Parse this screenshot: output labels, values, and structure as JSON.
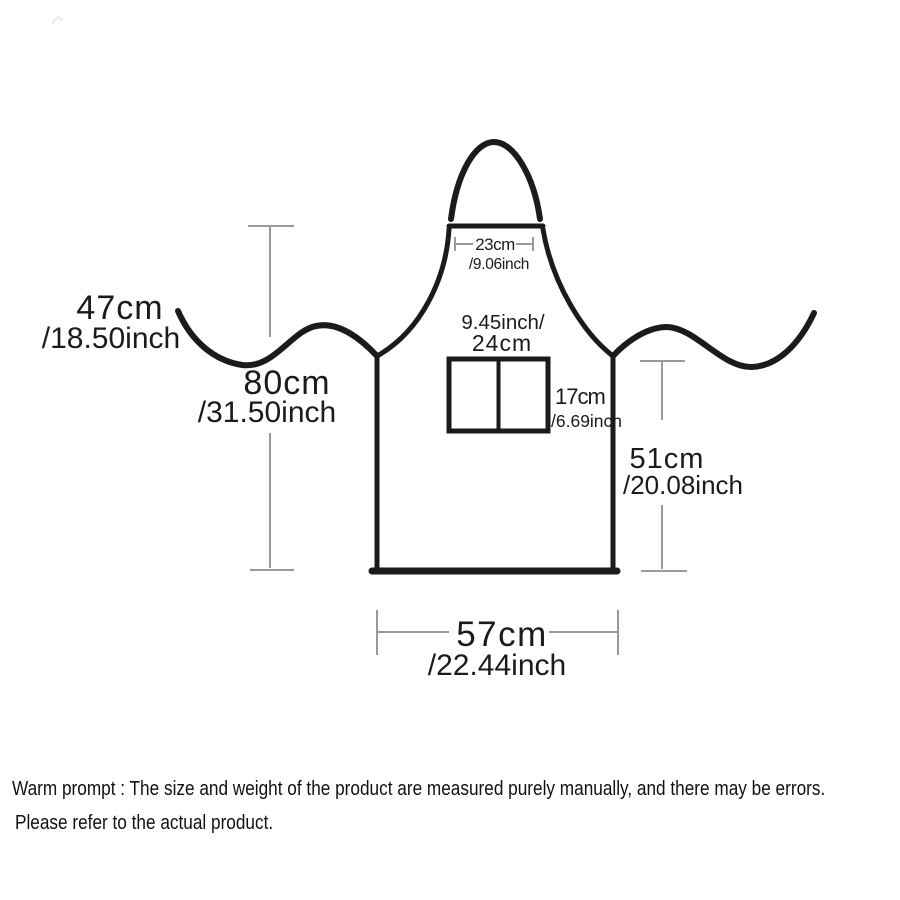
{
  "diagram": {
    "type": "apron-size-diagram",
    "measurements": {
      "strap_length": {
        "cm": "47cm",
        "inch": "/18.50inch"
      },
      "total_height": {
        "cm": "80cm",
        "inch": "/31.50inch"
      },
      "neck_width": {
        "cm": "23cm",
        "inch": "/9.06inch"
      },
      "pocket_width": {
        "line1": "9.45inch/",
        "line2": "24cm"
      },
      "pocket_height": {
        "cm": "17cm",
        "inch": "/6.69inch"
      },
      "body_height": {
        "cm": "51cm",
        "inch": "/20.08inch"
      },
      "bottom_width": {
        "cm": "57cm",
        "inch": "/22.44inch"
      }
    },
    "colors": {
      "outline": "#1b1b1b",
      "dimension_lines": "#9a9a9a",
      "text": "#1b1b1b",
      "background": "#ffffff"
    }
  },
  "footer": {
    "line1": "Warm prompt : The size and weight of the product are measured purely manually, and there may be errors.",
    "line2": "Please refer to the actual product."
  }
}
